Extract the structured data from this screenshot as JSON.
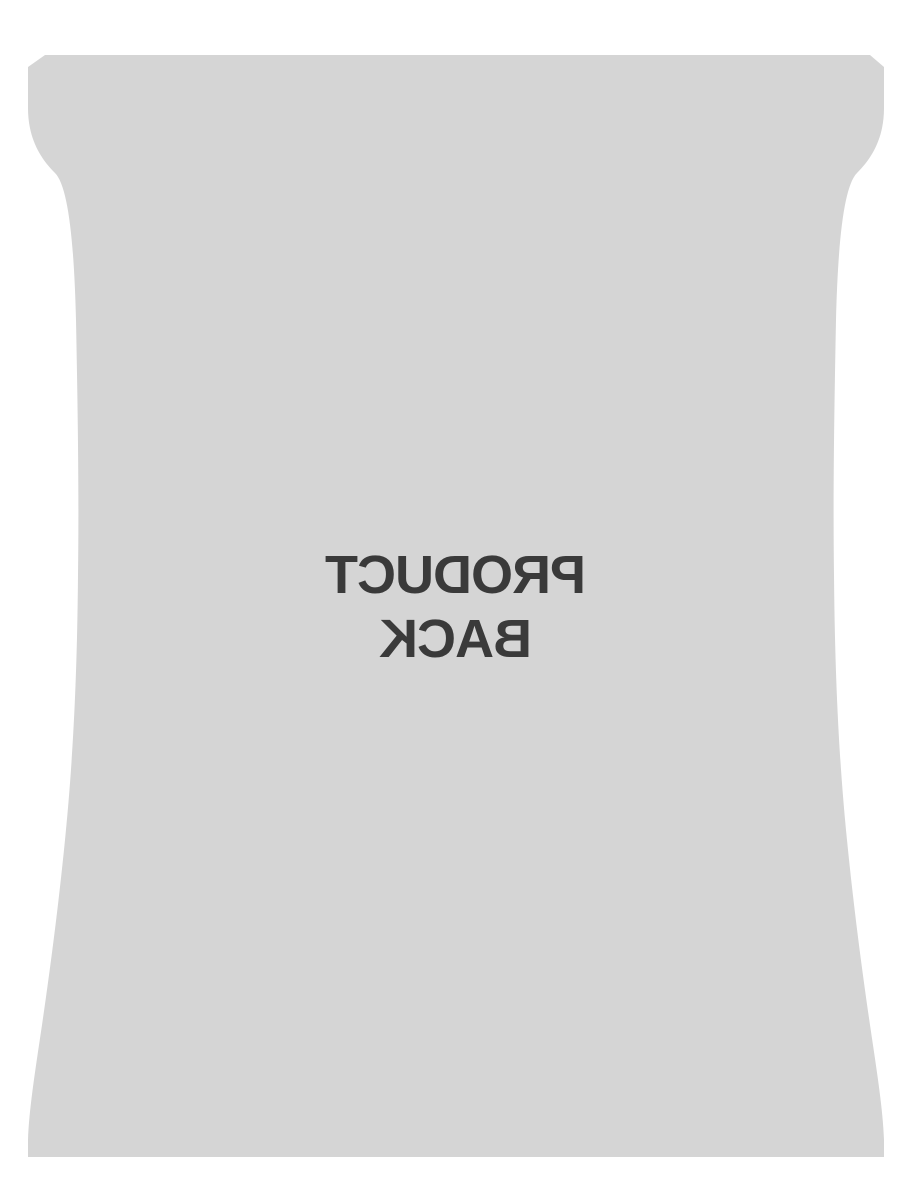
{
  "canvas": {
    "width": 900,
    "height": 1200,
    "background": "#ffffff"
  },
  "product_image": {
    "bag_color": "#d5d5d5",
    "text_color": "#3a3a3a",
    "label_line1": "PRODUCT",
    "label_line2": "BACK",
    "text_mirrored": true
  }
}
